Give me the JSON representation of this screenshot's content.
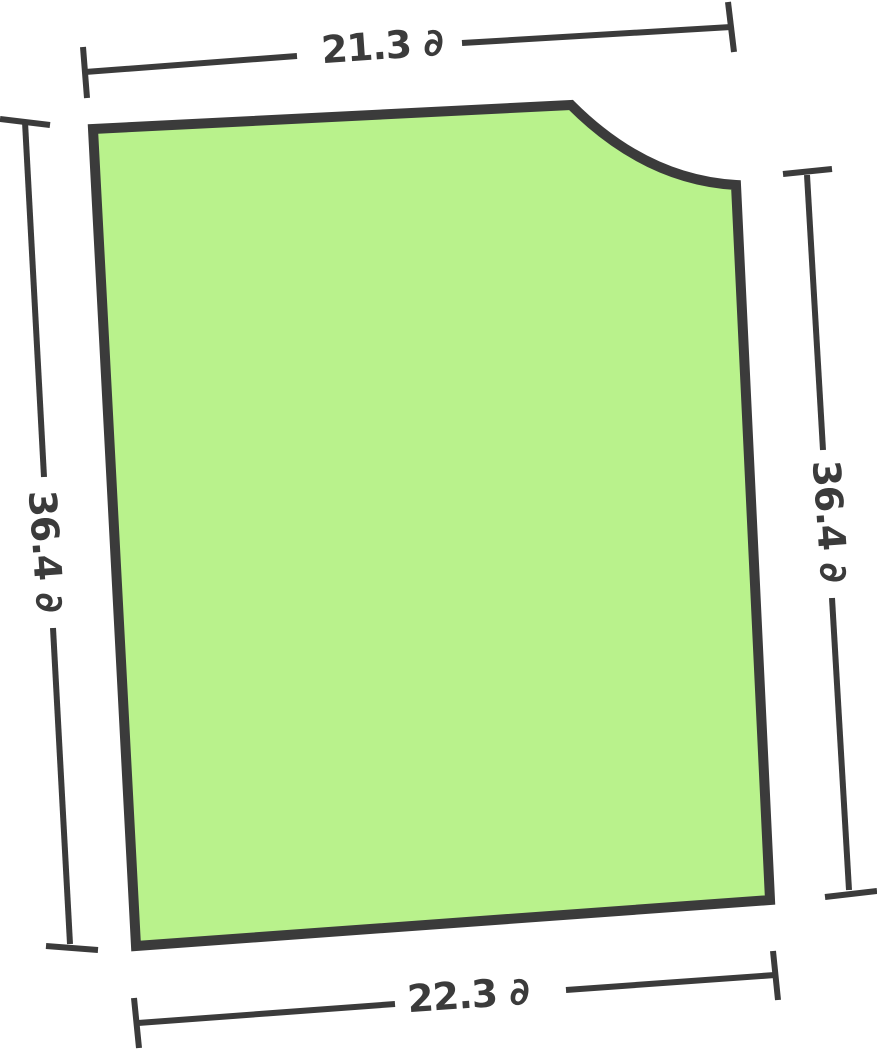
{
  "figure": {
    "description": "Irregular quadrilateral region with a concave rounded notch cut from the top-right corner, drawn slightly rotated, with four outside dimension lines",
    "shape_kind": "quadrilateral-with-notch",
    "fill_color": "#b9f28c",
    "outline_color": "#3b3b3b",
    "unit_symbol": "∂",
    "sides": {
      "top": {
        "value": 21.3,
        "label": "21.3 ∂"
      },
      "right": {
        "value": 36.4,
        "label": "36.4 ∂"
      },
      "bottom": {
        "value": 22.3,
        "label": "22.3 ∂"
      },
      "left": {
        "value": 36.4,
        "label": "36.4 ∂"
      }
    }
  }
}
